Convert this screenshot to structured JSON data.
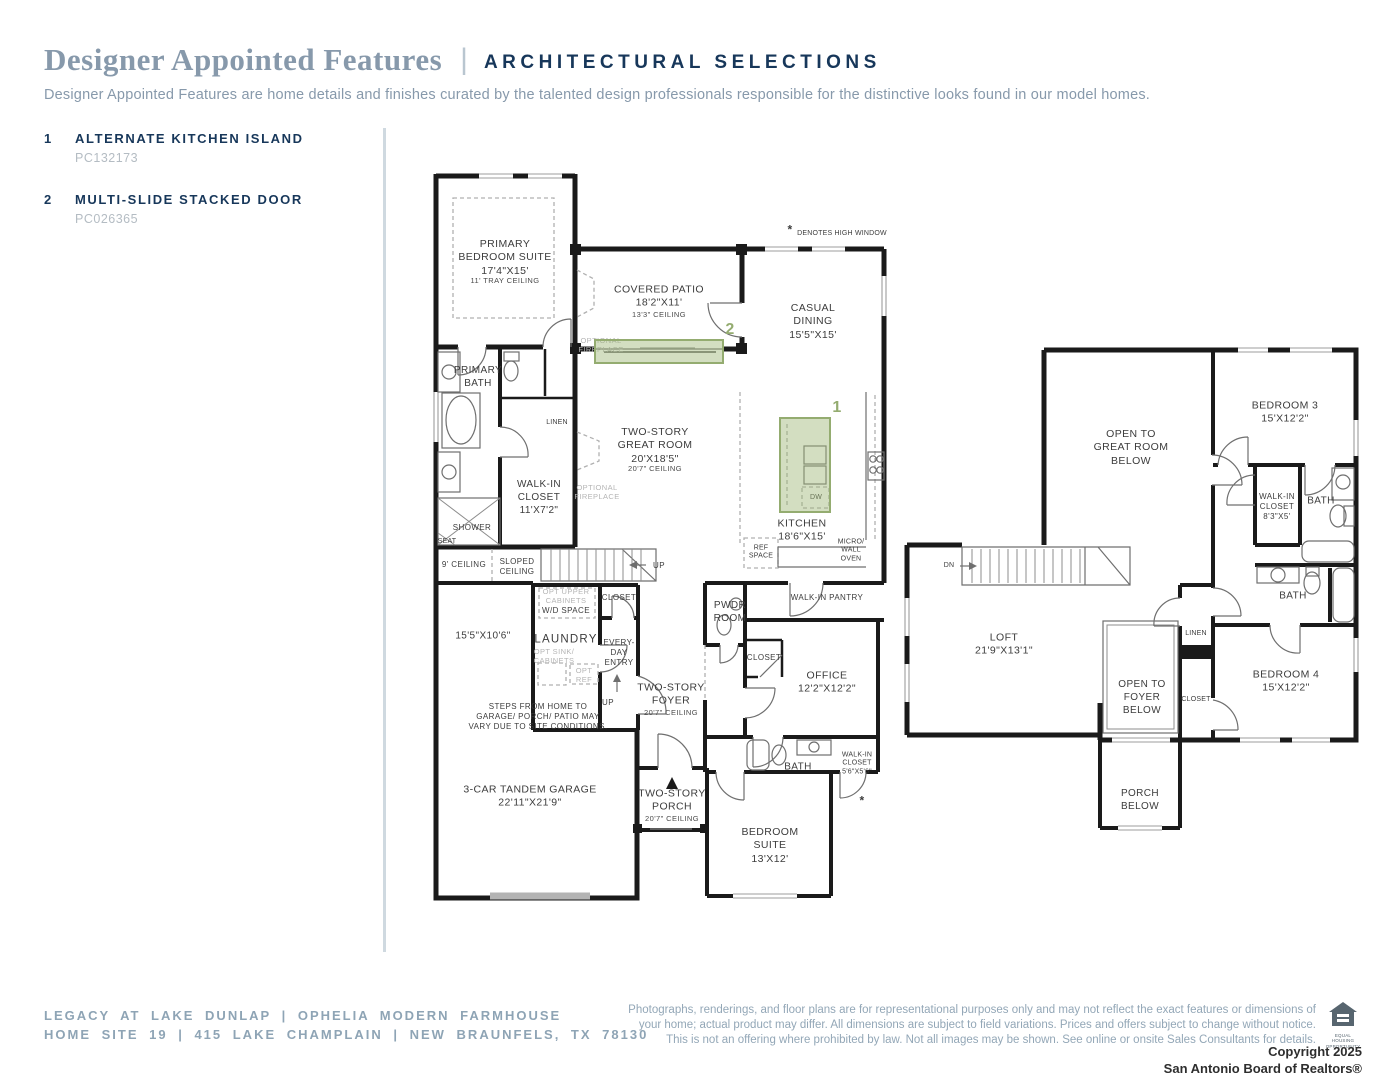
{
  "header": {
    "title": "Designer Appointed Features",
    "pipe": "|",
    "tag": "ARCHITECTURAL SELECTIONS",
    "description": "Designer Appointed Features are home details and finishes curated by the talented design professionals responsible for the distinctive looks found in our model homes."
  },
  "features": [
    {
      "num": "1",
      "label": "ALTERNATE KITCHEN ISLAND",
      "code": "PC132173"
    },
    {
      "num": "2",
      "label": "MULTI-SLIDE STACKED DOOR",
      "code": "PC026365"
    }
  ],
  "markers": {
    "one": "1",
    "two": "2",
    "star": "*"
  },
  "plans": {
    "floor1": {
      "primary_bedroom": {
        "name": "PRIMARY\nBEDROOM SUITE\n17'4\"X15'",
        "sub": "11' TRAY CEILING"
      },
      "covered_patio": {
        "name": "COVERED PATIO\n18'2\"X11'",
        "sub": "13'3\" CEILING"
      },
      "casual_dining": "CASUAL\nDINING\n15'5\"X15'",
      "high_window": "DENOTES HIGH WINDOW",
      "great_room": {
        "name": "TWO-STORY\nGREAT ROOM\n20'X18'5\"",
        "sub": "20'7\" CEILING"
      },
      "optional_fireplace": "OPTIONAL\nFIREPLACE",
      "kitchen": "KITCHEN\n18'6\"X15'",
      "dw": "DW",
      "ref_space": "REF\nSPACE",
      "micro_wall_oven": "MICRO/\nWALL\nOVEN",
      "walk_in_pantry": "WALK-IN PANTRY",
      "pwdr_room": "PWDR\nROOM",
      "closet": "CLOSET",
      "office": "OFFICE\n12'2\"X12'2\"",
      "bath": "BATH",
      "walk_in_closet_small": "WALK-IN\nCLOSET\n5'6\"X5'6\"",
      "bedroom_suite": "BEDROOM\nSUITE\n13'X12'",
      "two_story_porch": {
        "name": "TWO-STORY\nPORCH",
        "sub": "20'7\" CEILING"
      },
      "two_story_foyer": {
        "name": "TWO-STORY\nFOYER",
        "sub": "20'7\" CEILING"
      },
      "everyday_entry": "EVERY-\nDAY\nENTRY",
      "laundry": "LAUNDRY",
      "opt_upper_cabinets": "OPT UPPER\nCABINETS",
      "wd_space": "W/D SPACE",
      "opt_sink_cabinets": "OPT SINK/\nCABINETS",
      "opt_ref": "OPT\nREF",
      "up": "UP",
      "steps_note": "STEPS FROM HOME TO\nGARAGE/ PORCH/ PATIO MAY\nVARY DUE TO SITE CONDITIONS.",
      "garage_dim": "15'5\"X10'6\"",
      "ceiling_9": "9' CEILING",
      "sloped_ceiling": "SLOPED\nCEILING",
      "garage": "3-CAR TANDEM GARAGE\n22'11\"X21'9\"",
      "walk_in_closet": "WALK-IN\nCLOSET\n11'X7'2\"",
      "linen": "LINEN",
      "shower": "SHOWER",
      "seat": "SEAT",
      "primary_bath": "PRIMARY\nBATH"
    },
    "floor2": {
      "open_to_great_room": "OPEN TO\nGREAT ROOM\nBELOW",
      "bedroom3": "BEDROOM 3\n15'X12'2\"",
      "walk_in_closet_83": "WALK-IN\nCLOSET\n8'3\"X5'",
      "bath": "BATH",
      "dn": "DN",
      "loft": "LOFT\n21'9\"X13'1\"",
      "linen": "LINEN",
      "closet": "CLOSET",
      "open_to_foyer": "OPEN TO\nFOYER\nBELOW",
      "bedroom4": "BEDROOM 4\n15'X12'2\"",
      "porch_below": "PORCH\nBELOW"
    }
  },
  "footer": {
    "left": "LEGACY AT LAKE DUNLAP | OPHELIA MODERN FARMHOUSE\nHOME SITE 19 | 415 LAKE CHAMPLAIN | NEW BRAUNFELS, TX 78130",
    "disclaimer": "Photographs, renderings, and floor plans are for representational purposes only and may not reflect the exact features or dimensions of\nyour home; actual product may differ. All dimensions are subject to field variations. Prices and offers subject to change without notice.\nThis is not an offering where prohibited by law. Not all images may be shown. See online or onsite Sales Consultants for details.",
    "copyright": "Copyright 2025\nSan Antonio Board of Realtors®",
    "equal_housing": "EQUAL HOUSING\nOPPORTUNITY"
  },
  "colors": {
    "navy": "#17375a",
    "slate": "#8799ab",
    "accent_green": "#94ac70",
    "wall": "#1a1a1a"
  }
}
